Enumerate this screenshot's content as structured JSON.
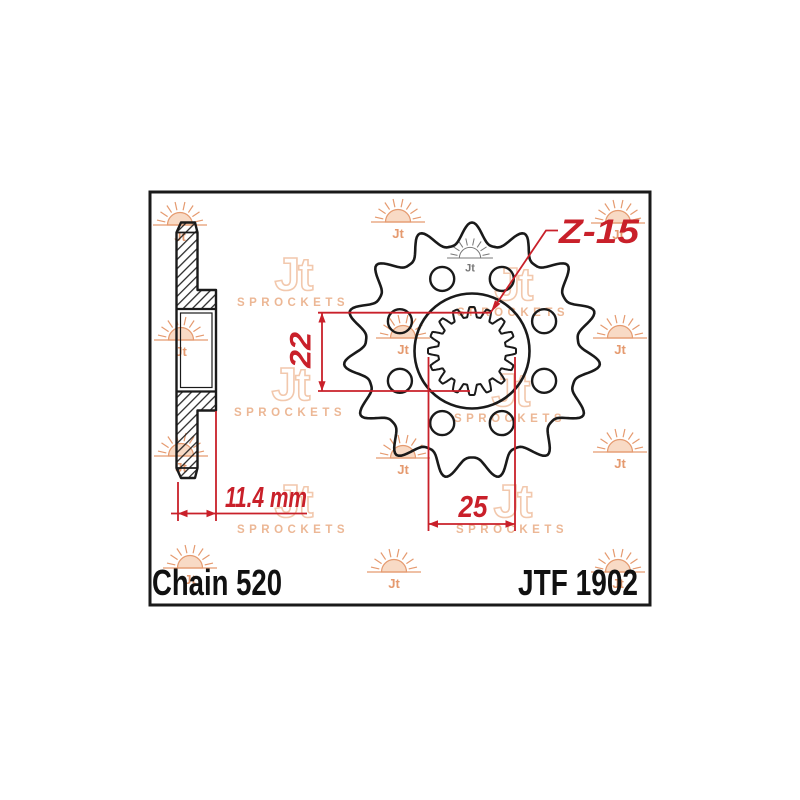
{
  "labels": {
    "chain": "Chain 520",
    "part_number": "JTF 1902"
  },
  "dimensions": {
    "bore_height": "22",
    "bore_width": "25",
    "hub_length": "11.4 mm",
    "teeth_label": "Z-15",
    "teeth_count": 15,
    "spline_bump_count": 16,
    "lightening_hole_count": 8
  },
  "watermark": {
    "monogram": "Jt",
    "brand": "Jt",
    "brand_subtitle": "SPROCKETS"
  },
  "colors": {
    "dimension_red": "#c9202a",
    "drawing_black": "#1a1a1a",
    "watermark_sun": "#e59a6f",
    "watermark_sun_fill": "#f3bc95",
    "watermark_logo": "#f2c8ad",
    "watermark_logo_text": "#ecb795",
    "center_mark_gray": "#787878"
  }
}
